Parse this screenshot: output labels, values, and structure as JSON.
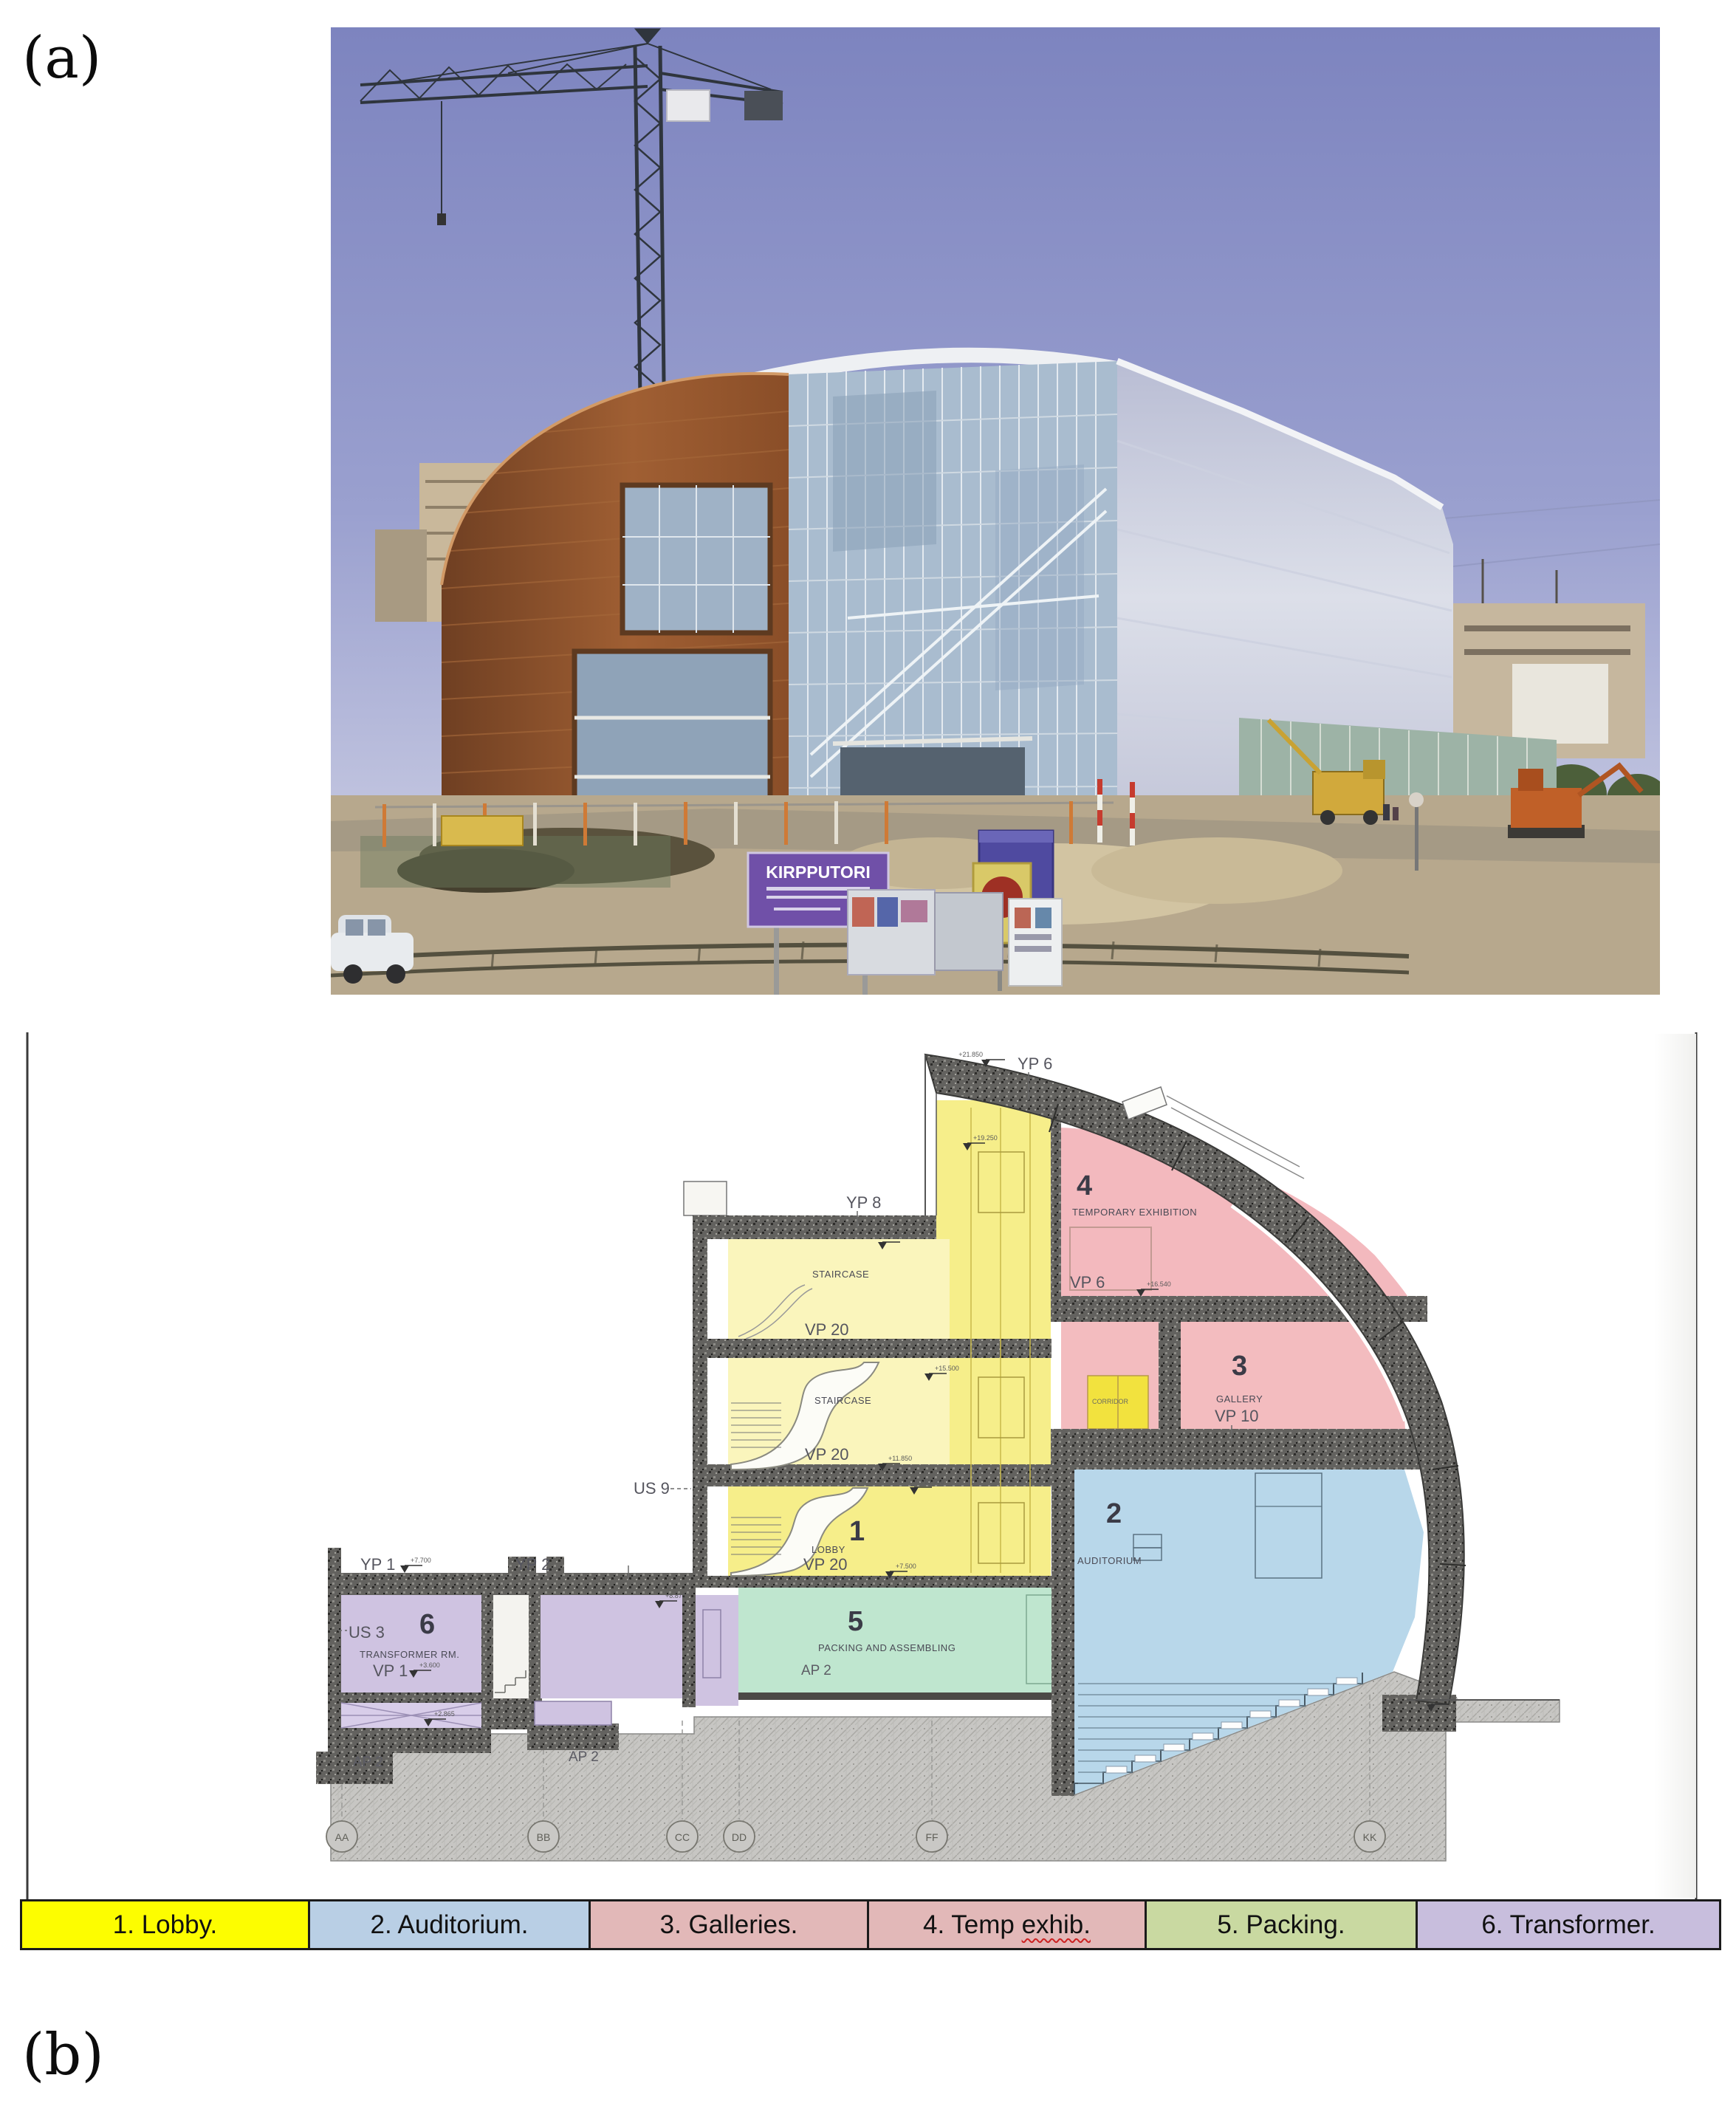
{
  "figure": {
    "panel_a_label": "(a)",
    "panel_b_label": "(b)"
  },
  "photo": {
    "sign_text": "KIRPPUTORI"
  },
  "section": {
    "codes": {
      "yp6": "YP 6",
      "yp8": "YP 8",
      "us9": "US 9",
      "yp1": "YP 1",
      "yp2": "YP 2",
      "us3": "US 3",
      "vp1": "VP 1",
      "vp6": "VP 6",
      "vp10": "VP 10",
      "vp20": "VP 20",
      "ap2": "AP 2"
    },
    "rooms": {
      "r1": {
        "num": "1",
        "name": "LOBBY"
      },
      "r2": {
        "num": "2",
        "name": "AUDITORIUM"
      },
      "r3": {
        "num": "3",
        "name": "GALLERY"
      },
      "r4": {
        "num": "4",
        "name": "TEMPORARY EXHIBITION"
      },
      "r5": {
        "num": "5",
        "name": "PACKING AND ASSEMBLING"
      },
      "r6": {
        "num": "6",
        "name": "TRANSFORMER RM."
      },
      "staircase": "STAIRCASE",
      "corridor": "CORRIDOR"
    },
    "grid_bubbles": [
      "AA",
      "BB",
      "CC",
      "DD",
      "FF",
      "KK"
    ],
    "elevations": [
      "+21.850",
      "+19.250",
      "+18.715",
      "+15.500",
      "+16.540",
      "+11.850",
      "+10.900",
      "+7.500",
      "+7.700",
      "+8.875",
      "+3.600",
      "+2.865",
      "+6.700"
    ]
  },
  "legend": {
    "items": [
      {
        "label": "1. Lobby.",
        "color": "#fdfd00"
      },
      {
        "label": "2. Auditorium.",
        "color": "#b9cfe5"
      },
      {
        "label": "3. Galleries.",
        "color": "#e2b8b8"
      },
      {
        "label": "4. Temp exhib.",
        "pre": "4. Temp ",
        "wavy": "exhib.",
        "color": "#e2b8b8"
      },
      {
        "label": "5. Packing.",
        "color": "#c9d9a1"
      },
      {
        "label": "6. Transformer.",
        "color": "#c8bedd"
      }
    ]
  },
  "colors": {
    "section_yellow": "#f6ee8a",
    "section_yellow_light": "#faf5bc",
    "section_pink": "#f3bcbf",
    "section_blue": "#b8d7ea",
    "section_green": "#bfe6cf",
    "section_purple": "#cfc3e1",
    "wall_hatch": "#63625f",
    "ground_hatch": "#c7c6c3",
    "sky": "#8087c0",
    "copper": "#9a5a33",
    "silver_wall": "#c9cbdd",
    "sign_purple": "#7050a8",
    "legend_wavy_underline": "#cc2222"
  }
}
